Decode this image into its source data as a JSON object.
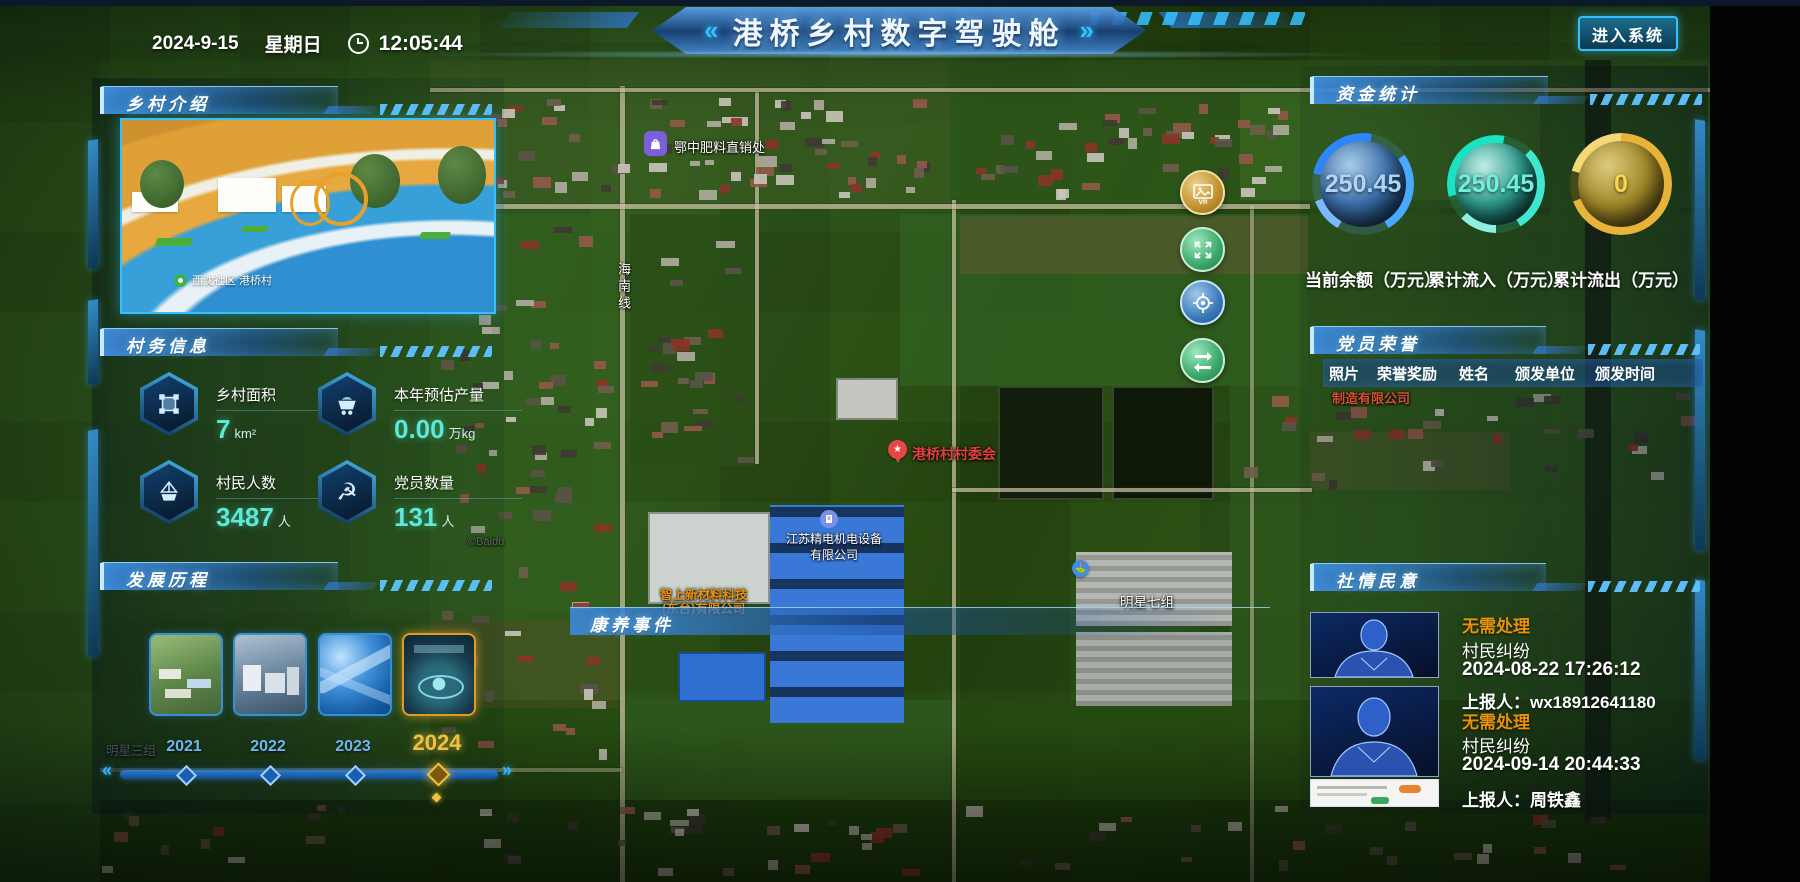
{
  "header": {
    "date": "2024-9-15",
    "weekday": "星期日",
    "time": "12:05:44",
    "title": "港桥乡村数字驾驶舱",
    "chevron_left": "«",
    "chevron_right": "»",
    "enter_button": "进入系统"
  },
  "panels": {
    "intro": {
      "title": "乡村介绍",
      "photo_caption": "西沈社区 港桥村"
    },
    "affairs": {
      "title": "村务信息",
      "stats": [
        {
          "label": "乡村面积",
          "value": "7",
          "unit": "km²",
          "icon": "area-icon"
        },
        {
          "label": "本年预估产量",
          "value": "0.00",
          "unit": "万kg",
          "icon": "cart-icon"
        },
        {
          "label": "村民人数",
          "value": "3487",
          "unit": "人",
          "icon": "boat-icon"
        },
        {
          "label": "党员数量",
          "value": "131",
          "unit": "人",
          "icon": "party-icon"
        }
      ]
    },
    "history": {
      "title": "发展历程",
      "years": [
        {
          "label": "2021",
          "selected": false
        },
        {
          "label": "2022",
          "selected": false
        },
        {
          "label": "2023",
          "selected": false
        },
        {
          "label": "2024",
          "selected": true
        }
      ]
    },
    "funds": {
      "title": "资金统计",
      "gauges": [
        {
          "value": "250.45",
          "label": "当前余额（万元）",
          "color": "#2e86ff"
        },
        {
          "value": "250.45",
          "label": "累计流入（万元）",
          "color": "#19e3c2"
        },
        {
          "value": "0",
          "label": "累计流出（万元）",
          "color": "#e8b339"
        }
      ]
    },
    "honors": {
      "title": "党员荣誉",
      "columns": [
        "照片",
        "荣誉奖励",
        "姓名",
        "颁发单位",
        "颁发时间"
      ]
    },
    "sentiment": {
      "title": "社情民意",
      "items": [
        {
          "status": "无需处理",
          "type": "村民纠纷",
          "time": "2024-08-22 17:26:12",
          "reporter": "上报人：wx18912641180"
        },
        {
          "status": "无需处理",
          "type": "村民纠纷",
          "time": "2024-09-14 20:44:33",
          "reporter": "上报人：周铁鑫"
        }
      ]
    },
    "health_events": {
      "title": "康养事件"
    }
  },
  "map": {
    "labels": {
      "fertilizer": "鄂中肥料直销处",
      "road_vertical": "海南线",
      "committee": "港桥村村委会",
      "company1_line1": "江苏精电机电设备",
      "company1_line2": "有限公司",
      "company2_line1": "智上新材料科技",
      "company2_line2": "(东台)有限公司",
      "group7": "明星七组",
      "group3": "明星三组",
      "factory_fragment": "制造有限公司",
      "watermark": "©Baidu",
      "committee_star": "★",
      "vr_label": "VR"
    }
  }
}
